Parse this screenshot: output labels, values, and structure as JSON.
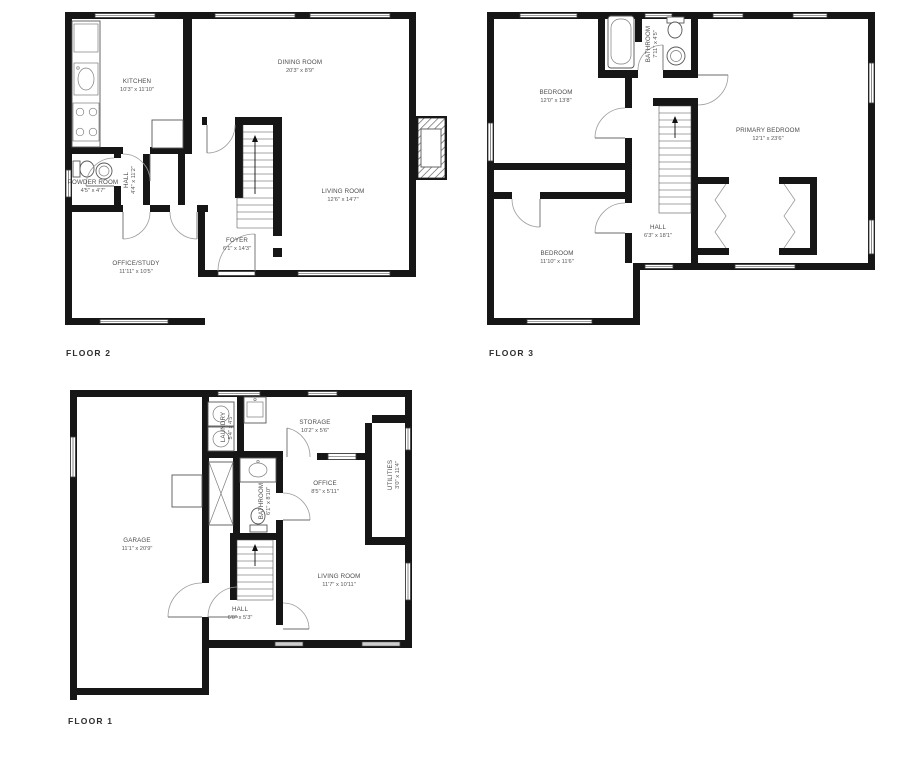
{
  "colors": {
    "background": "#ffffff",
    "wall": "#161616",
    "thin_line": "#7d7d7d",
    "label_text": "#4c4c4c"
  },
  "floor2": {
    "label": "FLOOR 2",
    "rooms": {
      "kitchen": {
        "name": "KITCHEN",
        "dims": "10'3\" x 11'10\""
      },
      "dining_room": {
        "name": "DINING ROOM",
        "dims": "20'3\" x 8'9\""
      },
      "living_room": {
        "name": "LIVING ROOM",
        "dims": "12'6\" x 14'7\""
      },
      "powder_room": {
        "name": "POWDER ROOM",
        "dims": "4'5\" x 4'7\""
      },
      "hall": {
        "name": "HALL",
        "dims": "4'4\" x 11'2\""
      },
      "office_study": {
        "name": "OFFICE/STUDY",
        "dims": "11'11\" x 10'5\""
      },
      "foyer": {
        "name": "FOYER",
        "dims": "6'1\" x 14'3\""
      }
    }
  },
  "floor3": {
    "label": "FLOOR 3",
    "rooms": {
      "bedroom_top": {
        "name": "BEDROOM",
        "dims": "12'0\" x 13'8\""
      },
      "primary_bedroom": {
        "name": "PRIMARY BEDROOM",
        "dims": "12'1\" x 23'6\""
      },
      "bathroom": {
        "name": "BATHROOM",
        "dims": "7'11\" x 4'5\""
      },
      "hall": {
        "name": "HALL",
        "dims": "6'3\" x 18'1\""
      },
      "bedroom_bottom": {
        "name": "BEDROOM",
        "dims": "11'10\" x 11'6\""
      }
    }
  },
  "floor1": {
    "label": "FLOOR 1",
    "rooms": {
      "garage": {
        "name": "GARAGE",
        "dims": "11'1\" x 20'9\""
      },
      "laundry": {
        "name": "LAUNDRY",
        "dims": "5'4\" x 4'5\""
      },
      "storage": {
        "name": "STORAGE",
        "dims": "10'2\" x 5'6\""
      },
      "office": {
        "name": "OFFICE",
        "dims": "8'5\" x 5'11\""
      },
      "utilities": {
        "name": "UTILITIES",
        "dims": "3'0\" x 11'4\""
      },
      "bathroom": {
        "name": "BATHROOM",
        "dims": "6'1\" x 8'10\""
      },
      "hall": {
        "name": "HALL",
        "dims": "6'0\" x 5'3\""
      },
      "living_room": {
        "name": "LIVING ROOM",
        "dims": "11'7\" x 10'11\""
      }
    }
  }
}
